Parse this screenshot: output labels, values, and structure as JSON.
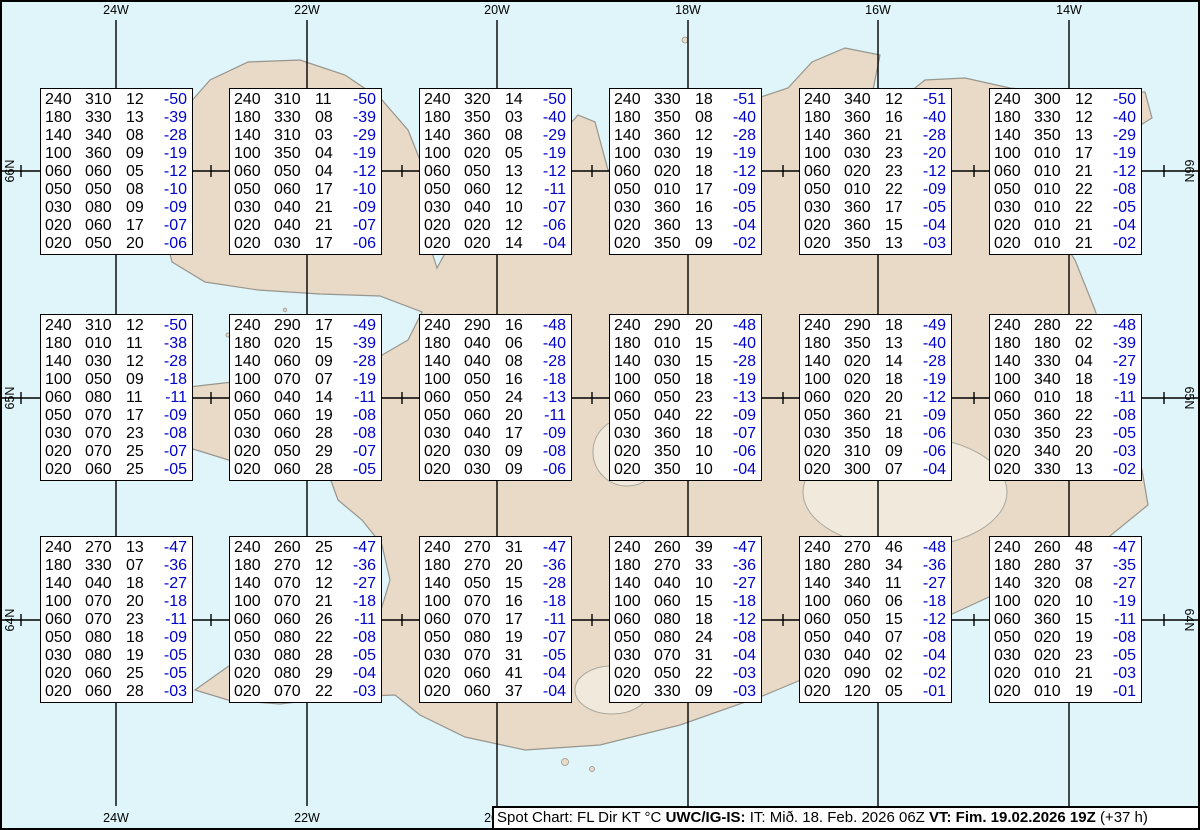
{
  "graticule": {
    "longitudes": [
      "24W",
      "22W",
      "20W",
      "18W",
      "16W",
      "14W"
    ],
    "latitudes": [
      "66N",
      "65N",
      "64N"
    ]
  },
  "footer": {
    "product_label": "Spot Chart: FL Dir KT °C",
    "source": "UWC/IG-IS:",
    "issue_time": "IT: Mið. 18. Feb. 2026 06Z",
    "valid_time": "VT: Fim. 19.02.2026 19Z",
    "lead_time": "(+37 h)"
  },
  "columns_meaning": [
    "FL",
    "Dir",
    "KT",
    "°C"
  ],
  "colors": {
    "water": "#dff5fa",
    "land": "#e8dac7",
    "coastline": "#97958e",
    "data_text": "#000000",
    "temperature_text": "#0000cc"
  },
  "boxes": [
    {
      "rows": [
        [
          "240",
          "310",
          "12",
          "-50"
        ],
        [
          "180",
          "330",
          "13",
          "-39"
        ],
        [
          "140",
          "340",
          "08",
          "-28"
        ],
        [
          "100",
          "360",
          "09",
          "-19"
        ],
        [
          "060",
          "060",
          "05",
          "-12"
        ],
        [
          "050",
          "050",
          "08",
          "-10"
        ],
        [
          "030",
          "080",
          "09",
          "-09"
        ],
        [
          "020",
          "060",
          "17",
          "-07"
        ],
        [
          "020",
          "050",
          "20",
          "-06"
        ]
      ]
    },
    {
      "rows": [
        [
          "240",
          "310",
          "11",
          "-50"
        ],
        [
          "180",
          "330",
          "08",
          "-39"
        ],
        [
          "140",
          "310",
          "03",
          "-29"
        ],
        [
          "100",
          "350",
          "04",
          "-19"
        ],
        [
          "060",
          "050",
          "04",
          "-12"
        ],
        [
          "050",
          "060",
          "17",
          "-10"
        ],
        [
          "030",
          "040",
          "21",
          "-09"
        ],
        [
          "020",
          "040",
          "21",
          "-07"
        ],
        [
          "020",
          "030",
          "17",
          "-06"
        ]
      ]
    },
    {
      "rows": [
        [
          "240",
          "320",
          "14",
          "-50"
        ],
        [
          "180",
          "350",
          "03",
          "-40"
        ],
        [
          "140",
          "360",
          "08",
          "-29"
        ],
        [
          "100",
          "020",
          "05",
          "-19"
        ],
        [
          "060",
          "050",
          "13",
          "-12"
        ],
        [
          "050",
          "060",
          "12",
          "-11"
        ],
        [
          "030",
          "040",
          "10",
          "-07"
        ],
        [
          "020",
          "020",
          "12",
          "-06"
        ],
        [
          "020",
          "020",
          "14",
          "-04"
        ]
      ]
    },
    {
      "rows": [
        [
          "240",
          "330",
          "18",
          "-51"
        ],
        [
          "180",
          "350",
          "08",
          "-40"
        ],
        [
          "140",
          "360",
          "12",
          "-28"
        ],
        [
          "100",
          "030",
          "19",
          "-19"
        ],
        [
          "060",
          "020",
          "18",
          "-12"
        ],
        [
          "050",
          "010",
          "17",
          "-09"
        ],
        [
          "030",
          "360",
          "16",
          "-05"
        ],
        [
          "020",
          "360",
          "13",
          "-04"
        ],
        [
          "020",
          "350",
          "09",
          "-02"
        ]
      ]
    },
    {
      "rows": [
        [
          "240",
          "340",
          "12",
          "-51"
        ],
        [
          "180",
          "360",
          "16",
          "-40"
        ],
        [
          "140",
          "360",
          "21",
          "-28"
        ],
        [
          "100",
          "030",
          "23",
          "-20"
        ],
        [
          "060",
          "020",
          "23",
          "-12"
        ],
        [
          "050",
          "010",
          "22",
          "-09"
        ],
        [
          "030",
          "360",
          "17",
          "-05"
        ],
        [
          "020",
          "360",
          "15",
          "-04"
        ],
        [
          "020",
          "350",
          "13",
          "-03"
        ]
      ]
    },
    {
      "rows": [
        [
          "240",
          "300",
          "12",
          "-50"
        ],
        [
          "180",
          "330",
          "12",
          "-40"
        ],
        [
          "140",
          "350",
          "13",
          "-29"
        ],
        [
          "100",
          "010",
          "17",
          "-19"
        ],
        [
          "060",
          "010",
          "21",
          "-12"
        ],
        [
          "050",
          "010",
          "22",
          "-08"
        ],
        [
          "030",
          "010",
          "22",
          "-05"
        ],
        [
          "020",
          "010",
          "21",
          "-04"
        ],
        [
          "020",
          "010",
          "21",
          "-02"
        ]
      ]
    },
    {
      "rows": [
        [
          "240",
          "310",
          "12",
          "-50"
        ],
        [
          "180",
          "010",
          "11",
          "-38"
        ],
        [
          "140",
          "030",
          "12",
          "-28"
        ],
        [
          "100",
          "050",
          "09",
          "-18"
        ],
        [
          "060",
          "080",
          "11",
          "-11"
        ],
        [
          "050",
          "070",
          "17",
          "-09"
        ],
        [
          "030",
          "070",
          "23",
          "-08"
        ],
        [
          "020",
          "070",
          "25",
          "-07"
        ],
        [
          "020",
          "060",
          "25",
          "-05"
        ]
      ]
    },
    {
      "rows": [
        [
          "240",
          "290",
          "17",
          "-49"
        ],
        [
          "180",
          "020",
          "15",
          "-39"
        ],
        [
          "140",
          "060",
          "09",
          "-28"
        ],
        [
          "100",
          "070",
          "07",
          "-19"
        ],
        [
          "060",
          "040",
          "14",
          "-11"
        ],
        [
          "050",
          "060",
          "19",
          "-08"
        ],
        [
          "030",
          "060",
          "28",
          "-08"
        ],
        [
          "020",
          "050",
          "29",
          "-07"
        ],
        [
          "020",
          "060",
          "28",
          "-05"
        ]
      ]
    },
    {
      "rows": [
        [
          "240",
          "290",
          "16",
          "-48"
        ],
        [
          "180",
          "040",
          "06",
          "-40"
        ],
        [
          "140",
          "040",
          "08",
          "-28"
        ],
        [
          "100",
          "050",
          "16",
          "-18"
        ],
        [
          "060",
          "050",
          "24",
          "-13"
        ],
        [
          "050",
          "060",
          "20",
          "-11"
        ],
        [
          "030",
          "040",
          "17",
          "-09"
        ],
        [
          "020",
          "030",
          "09",
          "-08"
        ],
        [
          "020",
          "030",
          "09",
          "-06"
        ]
      ]
    },
    {
      "rows": [
        [
          "240",
          "290",
          "20",
          "-48"
        ],
        [
          "180",
          "010",
          "15",
          "-40"
        ],
        [
          "140",
          "030",
          "15",
          "-28"
        ],
        [
          "100",
          "050",
          "18",
          "-19"
        ],
        [
          "060",
          "050",
          "23",
          "-13"
        ],
        [
          "050",
          "040",
          "22",
          "-09"
        ],
        [
          "030",
          "360",
          "18",
          "-07"
        ],
        [
          "020",
          "350",
          "10",
          "-06"
        ],
        [
          "020",
          "350",
          "10",
          "-04"
        ]
      ]
    },
    {
      "rows": [
        [
          "240",
          "290",
          "18",
          "-49"
        ],
        [
          "180",
          "350",
          "13",
          "-40"
        ],
        [
          "140",
          "020",
          "14",
          "-28"
        ],
        [
          "100",
          "020",
          "18",
          "-19"
        ],
        [
          "060",
          "020",
          "20",
          "-12"
        ],
        [
          "050",
          "360",
          "21",
          "-09"
        ],
        [
          "030",
          "350",
          "18",
          "-06"
        ],
        [
          "020",
          "310",
          "09",
          "-06"
        ],
        [
          "020",
          "300",
          "07",
          "-04"
        ]
      ]
    },
    {
      "rows": [
        [
          "240",
          "280",
          "22",
          "-48"
        ],
        [
          "180",
          "180",
          "02",
          "-39"
        ],
        [
          "140",
          "330",
          "04",
          "-27"
        ],
        [
          "100",
          "340",
          "18",
          "-19"
        ],
        [
          "060",
          "010",
          "18",
          "-11"
        ],
        [
          "050",
          "360",
          "22",
          "-08"
        ],
        [
          "030",
          "350",
          "23",
          "-05"
        ],
        [
          "020",
          "340",
          "20",
          "-03"
        ],
        [
          "020",
          "330",
          "13",
          "-02"
        ]
      ]
    },
    {
      "rows": [
        [
          "240",
          "270",
          "13",
          "-47"
        ],
        [
          "180",
          "330",
          "07",
          "-36"
        ],
        [
          "140",
          "040",
          "18",
          "-27"
        ],
        [
          "100",
          "070",
          "20",
          "-18"
        ],
        [
          "060",
          "070",
          "23",
          "-11"
        ],
        [
          "050",
          "080",
          "18",
          "-09"
        ],
        [
          "030",
          "080",
          "19",
          "-05"
        ],
        [
          "020",
          "060",
          "25",
          "-05"
        ],
        [
          "020",
          "060",
          "28",
          "-03"
        ]
      ]
    },
    {
      "rows": [
        [
          "240",
          "260",
          "25",
          "-47"
        ],
        [
          "180",
          "270",
          "12",
          "-36"
        ],
        [
          "140",
          "070",
          "12",
          "-27"
        ],
        [
          "100",
          "070",
          "21",
          "-18"
        ],
        [
          "060",
          "060",
          "26",
          "-11"
        ],
        [
          "050",
          "080",
          "22",
          "-08"
        ],
        [
          "030",
          "080",
          "28",
          "-05"
        ],
        [
          "020",
          "080",
          "29",
          "-04"
        ],
        [
          "020",
          "070",
          "22",
          "-03"
        ]
      ]
    },
    {
      "rows": [
        [
          "240",
          "270",
          "31",
          "-47"
        ],
        [
          "180",
          "270",
          "20",
          "-36"
        ],
        [
          "140",
          "050",
          "15",
          "-28"
        ],
        [
          "100",
          "070",
          "16",
          "-18"
        ],
        [
          "060",
          "070",
          "17",
          "-11"
        ],
        [
          "050",
          "080",
          "19",
          "-07"
        ],
        [
          "030",
          "070",
          "31",
          "-05"
        ],
        [
          "020",
          "060",
          "41",
          "-04"
        ],
        [
          "020",
          "060",
          "37",
          "-04"
        ]
      ]
    },
    {
      "rows": [
        [
          "240",
          "260",
          "39",
          "-47"
        ],
        [
          "180",
          "270",
          "33",
          "-36"
        ],
        [
          "140",
          "040",
          "10",
          "-27"
        ],
        [
          "100",
          "060",
          "15",
          "-18"
        ],
        [
          "060",
          "080",
          "18",
          "-12"
        ],
        [
          "050",
          "080",
          "24",
          "-08"
        ],
        [
          "030",
          "070",
          "31",
          "-04"
        ],
        [
          "020",
          "050",
          "22",
          "-03"
        ],
        [
          "020",
          "330",
          "09",
          "-03"
        ]
      ]
    },
    {
      "rows": [
        [
          "240",
          "270",
          "46",
          "-48"
        ],
        [
          "180",
          "280",
          "34",
          "-36"
        ],
        [
          "140",
          "340",
          "11",
          "-27"
        ],
        [
          "100",
          "060",
          "06",
          "-18"
        ],
        [
          "060",
          "050",
          "15",
          "-12"
        ],
        [
          "050",
          "040",
          "07",
          "-08"
        ],
        [
          "030",
          "040",
          "02",
          "-04"
        ],
        [
          "020",
          "090",
          "02",
          "-02"
        ],
        [
          "020",
          "120",
          "05",
          "-01"
        ]
      ]
    },
    {
      "rows": [
        [
          "240",
          "260",
          "48",
          "-47"
        ],
        [
          "180",
          "280",
          "37",
          "-35"
        ],
        [
          "140",
          "320",
          "08",
          "-27"
        ],
        [
          "100",
          "020",
          "10",
          "-19"
        ],
        [
          "060",
          "360",
          "15",
          "-11"
        ],
        [
          "050",
          "020",
          "19",
          "-08"
        ],
        [
          "030",
          "020",
          "23",
          "-05"
        ],
        [
          "020",
          "010",
          "21",
          "-03"
        ],
        [
          "020",
          "010",
          "19",
          "-01"
        ]
      ]
    }
  ]
}
